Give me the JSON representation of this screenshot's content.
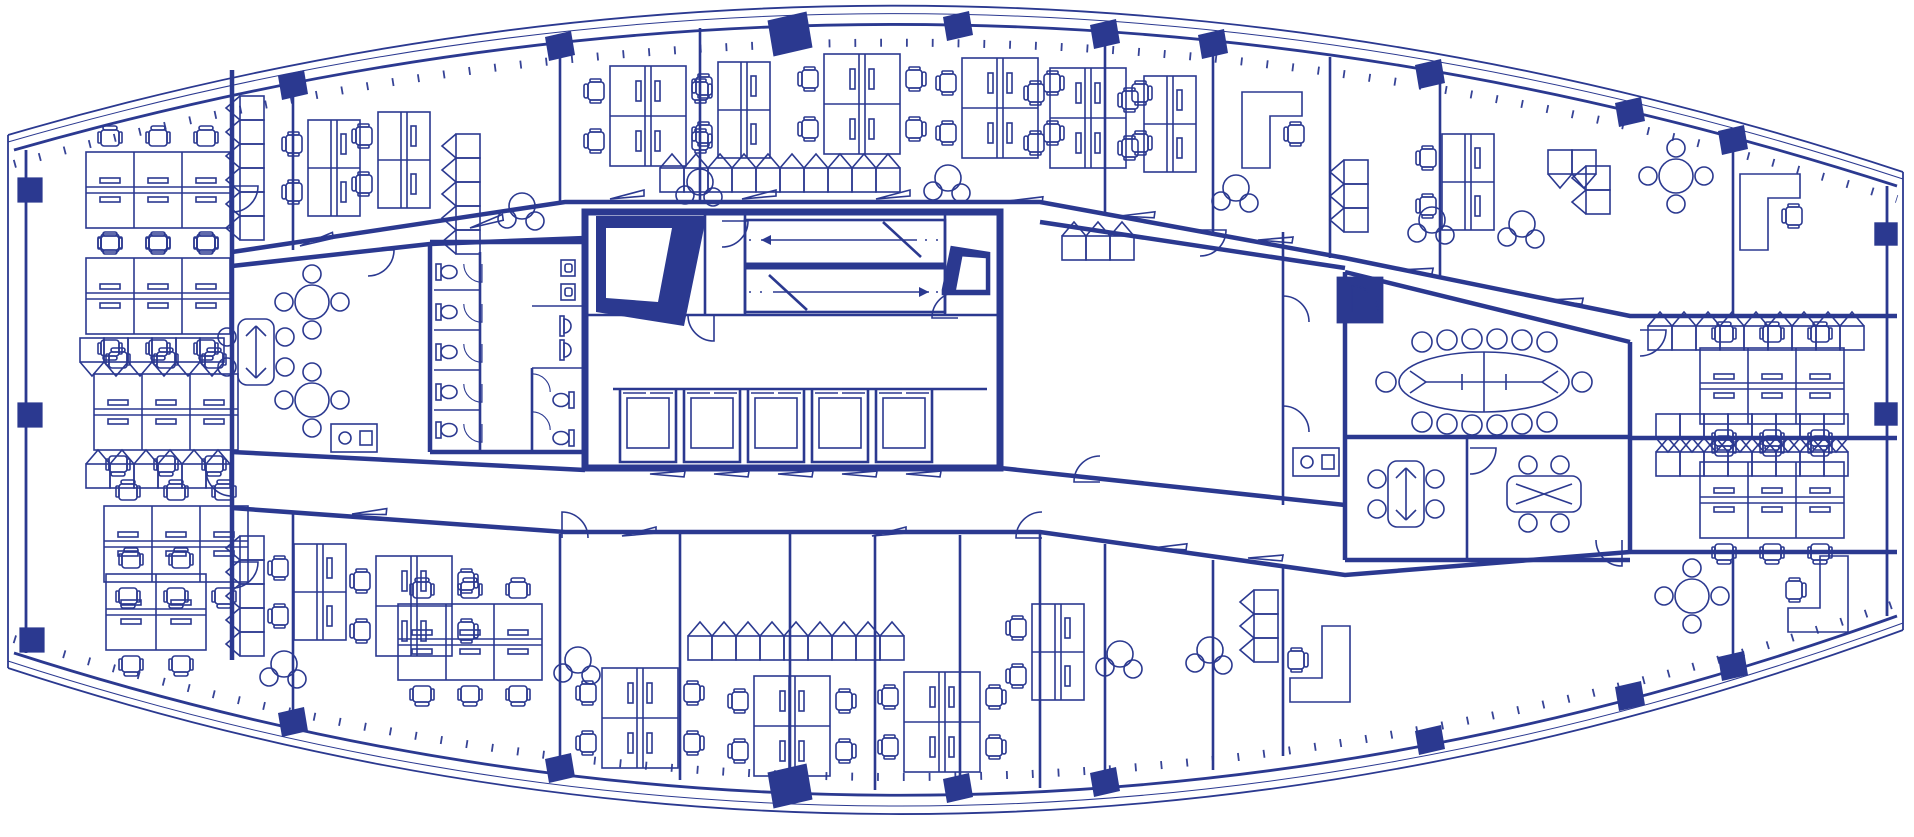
{
  "colors": {
    "ink": "#2b3990",
    "paper": "#ffffff"
  },
  "plan": {
    "canvas": {
      "width": 1914,
      "height": 837,
      "viewBox": "0 0 1914 837"
    },
    "drawing_type": "office-tower-typical-floor-plan",
    "symbols": [
      "desk-bench",
      "task-chair",
      "storage-cabinet",
      "round-table",
      "lounge-chairs",
      "boardroom-table",
      "meeting-table",
      "toilet",
      "urinal",
      "sink",
      "elevator",
      "stair",
      "door-swing",
      "door-leaf",
      "column",
      "l-shaped-desk",
      "kitchenette",
      "service-shaft"
    ],
    "furniture": [
      {
        "type": "bench6",
        "x": 158,
        "y": 190
      },
      {
        "type": "bench6",
        "x": 158,
        "y": 296
      },
      {
        "type": "cab",
        "x": 92,
        "y": 350,
        "n": 6,
        "dx": 24
      },
      {
        "type": "bench6",
        "x": 166,
        "y": 412
      },
      {
        "type": "cab",
        "x": 98,
        "y": 476,
        "n": 6,
        "dx": 24,
        "rot": 180
      },
      {
        "type": "bench6",
        "x": 176,
        "y": 544
      },
      {
        "type": "bench4",
        "x": 156,
        "y": 612
      },
      {
        "type": "col",
        "x": 30,
        "y": 190,
        "s": 1.4
      },
      {
        "type": "col",
        "x": 30,
        "y": 415,
        "s": 1.4
      },
      {
        "type": "col",
        "x": 32,
        "y": 640,
        "s": 1.4
      },
      {
        "type": "door90",
        "x": 232,
        "y": 186,
        "rot": 90
      },
      {
        "type": "door90",
        "x": 232,
        "y": 470,
        "rot": 180
      },
      {
        "type": "door90",
        "x": 232,
        "y": 562,
        "rot": 90
      },
      {
        "type": "cab",
        "x": 252,
        "y": 108,
        "n": 6,
        "dy": 24,
        "rot": 90
      },
      {
        "type": "bench2v",
        "x": 334,
        "y": 168
      },
      {
        "type": "bench2v",
        "x": 404,
        "y": 160
      },
      {
        "type": "cab",
        "x": 468,
        "y": 146,
        "n": 5,
        "dy": 24,
        "rot": 90
      },
      {
        "type": "lounge3",
        "x": 522,
        "y": 210
      },
      {
        "type": "bench4",
        "x": 648,
        "y": 116,
        "rot": 90
      },
      {
        "type": "bench2v",
        "x": 744,
        "y": 110
      },
      {
        "type": "lounge3",
        "x": 700,
        "y": 186
      },
      {
        "type": "bench4",
        "x": 862,
        "y": 104,
        "rot": 90
      },
      {
        "type": "bench4",
        "x": 1000,
        "y": 108,
        "rot": 90
      },
      {
        "type": "lounge3",
        "x": 948,
        "y": 182
      },
      {
        "type": "cab",
        "x": 672,
        "y": 180,
        "n": 10,
        "dx": 24,
        "rot": 180
      },
      {
        "type": "doorleaf",
        "x": 300,
        "y": 246,
        "rot": -8
      },
      {
        "type": "doorleaf",
        "x": 470,
        "y": 228,
        "rot": -8
      },
      {
        "type": "doorleaf",
        "x": 610,
        "y": 199
      },
      {
        "type": "doorleaf",
        "x": 742,
        "y": 199
      },
      {
        "type": "doorleaf",
        "x": 876,
        "y": 199
      },
      {
        "type": "doorleaf",
        "x": 1008,
        "y": 201,
        "rot": 8
      },
      {
        "type": "colp",
        "x": 293,
        "y": 85
      },
      {
        "type": "colp",
        "x": 560,
        "y": 46
      },
      {
        "type": "colp",
        "x": 790,
        "y": 34,
        "s": 1.5
      },
      {
        "type": "colp",
        "x": 958,
        "y": 26
      },
      {
        "type": "colp",
        "x": 1105,
        "y": 34
      },
      {
        "type": "colp",
        "x": 1213,
        "y": 44
      },
      {
        "type": "colp",
        "x": 1430,
        "y": 74
      },
      {
        "type": "colp",
        "x": 1630,
        "y": 112
      },
      {
        "type": "colp",
        "x": 1733,
        "y": 140
      },
      {
        "type": "bench4",
        "x": 1088,
        "y": 118,
        "rot": 90
      },
      {
        "type": "bench2v",
        "x": 1170,
        "y": 124
      },
      {
        "type": "Ldesk",
        "x": 1284,
        "y": 130
      },
      {
        "type": "lounge3",
        "x": 1236,
        "y": 192
      },
      {
        "type": "cab",
        "x": 1356,
        "y": 172,
        "n": 3,
        "dy": 24,
        "rot": 90
      },
      {
        "type": "bench2v",
        "x": 1468,
        "y": 182
      },
      {
        "type": "lounge3",
        "x": 1432,
        "y": 224
      },
      {
        "type": "lounge3",
        "x": 1522,
        "y": 228
      },
      {
        "type": "cab",
        "x": 1560,
        "y": 162,
        "n": 2,
        "dx": 24
      },
      {
        "type": "cab",
        "x": 1598,
        "y": 178,
        "n": 2,
        "dy": 24,
        "rot": 90
      },
      {
        "type": "round4",
        "x": 1676,
        "y": 176
      },
      {
        "type": "Ldesk",
        "x": 1782,
        "y": 212
      },
      {
        "type": "doorleaf",
        "x": 1120,
        "y": 216,
        "rot": 8
      },
      {
        "type": "doorleaf",
        "x": 1258,
        "y": 240,
        "rot": 10
      },
      {
        "type": "doorleaf",
        "x": 1398,
        "y": 270,
        "rot": 12
      },
      {
        "type": "doorleaf",
        "x": 1548,
        "y": 300,
        "rot": 12
      },
      {
        "type": "stair",
        "x": 845,
        "y": 266
      },
      {
        "type": "shaft",
        "x": 650,
        "y": 272
      },
      {
        "type": "shaft",
        "x": 966,
        "y": 270,
        "s": 0.45,
        "rot": 180
      },
      {
        "type": "elev",
        "x": 648,
        "y": 426
      },
      {
        "type": "elev",
        "x": 712,
        "y": 426
      },
      {
        "type": "elev",
        "x": 776,
        "y": 426
      },
      {
        "type": "elev",
        "x": 840,
        "y": 426
      },
      {
        "type": "elev",
        "x": 904,
        "y": 426
      },
      {
        "type": "door90",
        "x": 714,
        "y": 315,
        "rot": 180
      },
      {
        "type": "door90",
        "x": 958,
        "y": 318,
        "rot": 270
      },
      {
        "type": "door90",
        "x": 722,
        "y": 221,
        "rot": 90
      },
      {
        "type": "doorleaf",
        "x": 650,
        "y": 474,
        "rot": 10
      },
      {
        "type": "doorleaf",
        "x": 714,
        "y": 474,
        "rot": 10
      },
      {
        "type": "doorleaf",
        "x": 778,
        "y": 474,
        "rot": 10
      },
      {
        "type": "doorleaf",
        "x": 842,
        "y": 474,
        "rot": 10
      },
      {
        "type": "doorleaf",
        "x": 906,
        "y": 474,
        "rot": 10
      },
      {
        "type": "wc",
        "x": 450,
        "y": 272
      },
      {
        "type": "wc",
        "x": 450,
        "y": 312
      },
      {
        "type": "wc",
        "x": 450,
        "y": 352
      },
      {
        "type": "wc",
        "x": 450,
        "y": 392
      },
      {
        "type": "wc",
        "x": 450,
        "y": 430
      },
      {
        "type": "door90",
        "x": 482,
        "y": 264,
        "rot": 180,
        "s": 0.7
      },
      {
        "type": "door90",
        "x": 482,
        "y": 304,
        "rot": 180,
        "s": 0.7
      },
      {
        "type": "door90",
        "x": 482,
        "y": 344,
        "rot": 180,
        "s": 0.7
      },
      {
        "type": "door90",
        "x": 482,
        "y": 384,
        "rot": 180,
        "s": 0.7
      },
      {
        "type": "door90",
        "x": 482,
        "y": 424,
        "rot": 180,
        "s": 0.7
      },
      {
        "type": "urinal",
        "x": 568,
        "y": 268,
        "rot": 270
      },
      {
        "type": "urinal",
        "x": 568,
        "y": 292,
        "rot": 270
      },
      {
        "type": "sink",
        "x": 568,
        "y": 326,
        "rot": 270
      },
      {
        "type": "sink",
        "x": 568,
        "y": 350,
        "rot": 270
      },
      {
        "type": "wc",
        "x": 560,
        "y": 400,
        "rot": 180
      },
      {
        "type": "wc",
        "x": 560,
        "y": 438,
        "rot": 180
      },
      {
        "type": "door90",
        "x": 532,
        "y": 392,
        "s": 0.7
      },
      {
        "type": "door90",
        "x": 532,
        "y": 430,
        "s": 0.7
      },
      {
        "type": "round4",
        "x": 312,
        "y": 302
      },
      {
        "type": "round4",
        "x": 312,
        "y": 400
      },
      {
        "type": "meet4v",
        "x": 256,
        "y": 352
      },
      {
        "type": "kitchen",
        "x": 354,
        "y": 438
      },
      {
        "type": "door90",
        "x": 368,
        "y": 250,
        "rot": 90
      },
      {
        "type": "cab",
        "x": 1074,
        "y": 248,
        "n": 3,
        "dx": 24,
        "rot": 180
      },
      {
        "type": "door90",
        "x": 1200,
        "y": 230,
        "rot": 90
      },
      {
        "type": "door90",
        "x": 1283,
        "y": 322
      },
      {
        "type": "door90",
        "x": 1283,
        "y": 432
      },
      {
        "type": "kitchen",
        "x": 1316,
        "y": 462
      },
      {
        "type": "col",
        "x": 1360,
        "y": 300,
        "s": 2.6
      },
      {
        "type": "door90",
        "x": 1100,
        "y": 482,
        "rot": 270
      },
      {
        "type": "board16",
        "x": 1484,
        "y": 382
      },
      {
        "type": "door90",
        "x": 1352,
        "y": 312
      },
      {
        "type": "meet4v",
        "x": 1406,
        "y": 494
      },
      {
        "type": "meet4h",
        "x": 1544,
        "y": 494
      },
      {
        "type": "door90",
        "x": 1470,
        "y": 448,
        "rot": 90
      },
      {
        "type": "door90",
        "x": 1622,
        "y": 540,
        "rot": 180
      },
      {
        "type": "cab",
        "x": 1660,
        "y": 338,
        "n": 9,
        "dx": 24,
        "rot": 180
      },
      {
        "type": "bench6",
        "x": 1772,
        "y": 386
      },
      {
        "type": "cab",
        "x": 1668,
        "y": 426,
        "n": 8,
        "dx": 24
      },
      {
        "type": "cab",
        "x": 1668,
        "y": 464,
        "n": 8,
        "dx": 24,
        "rot": 180
      },
      {
        "type": "bench6",
        "x": 1772,
        "y": 500
      },
      {
        "type": "round4",
        "x": 1692,
        "y": 596
      },
      {
        "type": "Ldesk",
        "x": 1806,
        "y": 594,
        "rot": 180
      },
      {
        "type": "col",
        "x": 1886,
        "y": 234,
        "s": 1.3
      },
      {
        "type": "col",
        "x": 1886,
        "y": 414,
        "s": 1.3
      },
      {
        "type": "colp",
        "x": 1733,
        "y": 666
      },
      {
        "type": "door90",
        "x": 1640,
        "y": 330,
        "rot": 90
      },
      {
        "type": "cab",
        "x": 252,
        "y": 548,
        "n": 5,
        "dy": 24,
        "rot": 90
      },
      {
        "type": "bench2v",
        "x": 320,
        "y": 592
      },
      {
        "type": "bench4",
        "x": 414,
        "y": 606,
        "rot": 90
      },
      {
        "type": "lounge3",
        "x": 284,
        "y": 668
      },
      {
        "type": "bench6",
        "x": 470,
        "y": 642
      },
      {
        "type": "lounge3",
        "x": 578,
        "y": 664
      },
      {
        "type": "cab",
        "x": 700,
        "y": 648,
        "n": 9,
        "dx": 24,
        "rot": 180
      },
      {
        "type": "bench4",
        "x": 640,
        "y": 718,
        "rot": 90
      },
      {
        "type": "bench4",
        "x": 792,
        "y": 726,
        "rot": 90
      },
      {
        "type": "bench4",
        "x": 942,
        "y": 722,
        "rot": 90
      },
      {
        "type": "doorleaf",
        "x": 352,
        "y": 514,
        "rot": 6
      },
      {
        "type": "doorleaf",
        "x": 622,
        "y": 536
      },
      {
        "type": "doorleaf",
        "x": 872,
        "y": 536
      },
      {
        "type": "door90",
        "x": 562,
        "y": 538
      },
      {
        "type": "door90",
        "x": 1042,
        "y": 538,
        "rot": 270
      },
      {
        "type": "bench2v",
        "x": 1058,
        "y": 652
      },
      {
        "type": "lounge3",
        "x": 1120,
        "y": 658
      },
      {
        "type": "lounge3",
        "x": 1210,
        "y": 654
      },
      {
        "type": "Ldesk",
        "x": 1308,
        "y": 664,
        "rot": 180
      },
      {
        "type": "cab",
        "x": 1266,
        "y": 602,
        "n": 3,
        "dy": 24,
        "rot": 90
      },
      {
        "type": "doorleaf",
        "x": 1152,
        "y": 548,
        "rot": 8
      },
      {
        "type": "doorleaf",
        "x": 1248,
        "y": 558,
        "rot": 10
      },
      {
        "type": "colp",
        "x": 293,
        "y": 722
      },
      {
        "type": "colp",
        "x": 560,
        "y": 768
      },
      {
        "type": "colp",
        "x": 790,
        "y": 786,
        "s": 1.5
      },
      {
        "type": "colp",
        "x": 958,
        "y": 788
      },
      {
        "type": "colp",
        "x": 1105,
        "y": 782
      },
      {
        "type": "colp",
        "x": 1430,
        "y": 740
      },
      {
        "type": "colp",
        "x": 1630,
        "y": 696
      }
    ]
  }
}
